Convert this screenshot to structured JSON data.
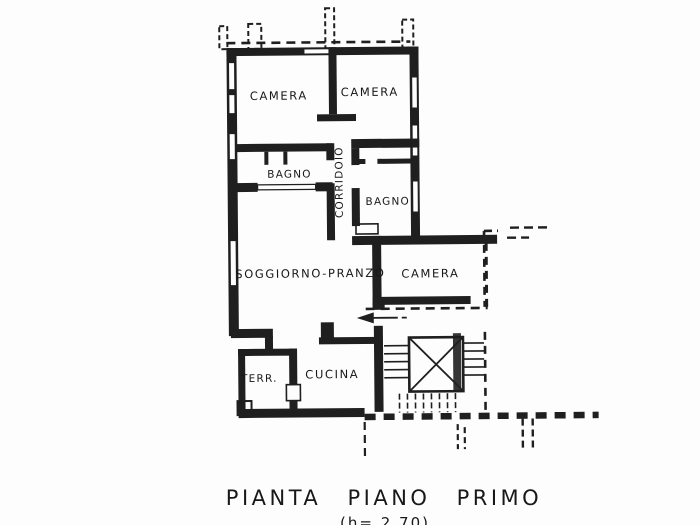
{
  "colors": {
    "ink": "#1f1f1f",
    "paper": "#fdfdfd"
  },
  "plan": {
    "rooms": [
      {
        "key": "camera-top-left",
        "label": "CAMERA"
      },
      {
        "key": "camera-top-right",
        "label": "CAMERA"
      },
      {
        "key": "bagno-left",
        "label": "BAGNO"
      },
      {
        "key": "corridoio",
        "label": "CORRIDOIO"
      },
      {
        "key": "bagno-right",
        "label": "BAGNO"
      },
      {
        "key": "soggiorno-pranzo",
        "label": "SOGGIORNO-PRANZO"
      },
      {
        "key": "camera-right",
        "label": "CAMERA"
      },
      {
        "key": "terrazzo",
        "label": "TERR."
      },
      {
        "key": "cucina",
        "label": "CUCINA"
      }
    ],
    "caption": "PIANTA PIANO PRIMO",
    "height_note": "(h= 2.70)"
  }
}
